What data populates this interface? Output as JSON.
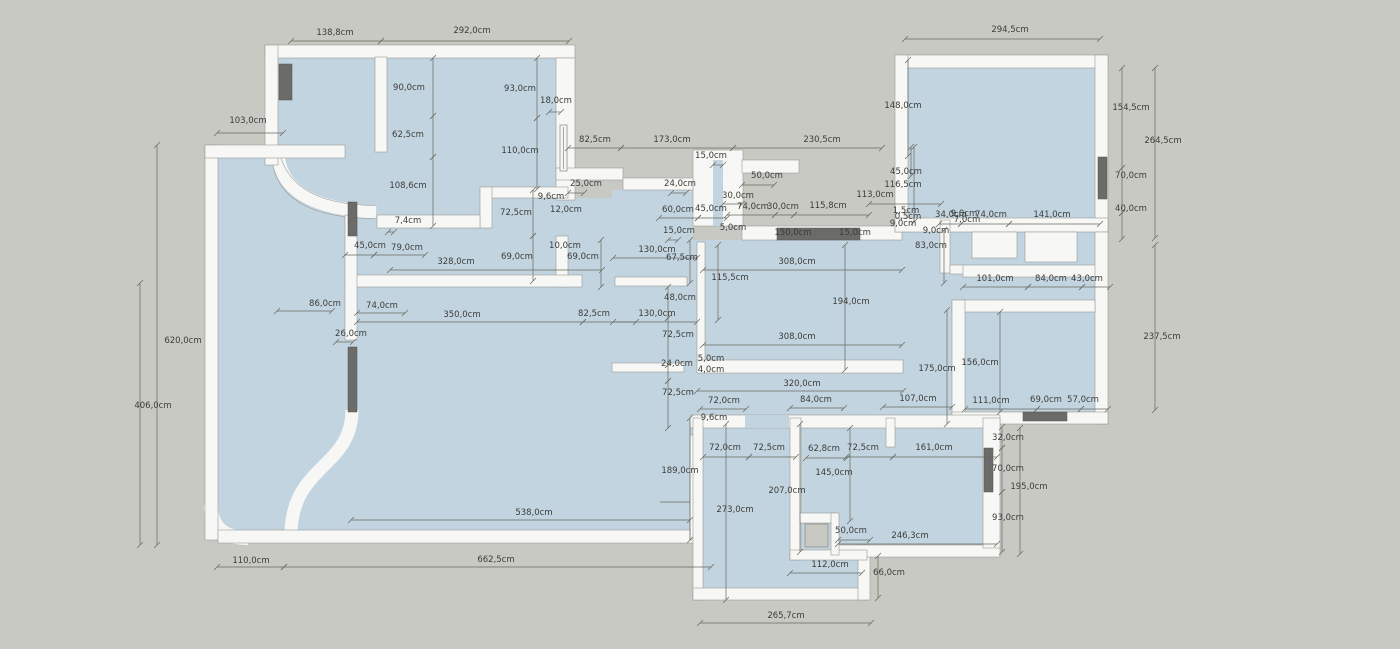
{
  "title": "apartment-floor-plan",
  "unit": "cm",
  "colors": {
    "background": "#c9c9c4",
    "floor": "#c3d4e1",
    "wall": "#f7f7f5",
    "wall_edge": "#9a9a96",
    "opening_dark": "#6b6b69",
    "dimension_line": "#68685f",
    "dimension_text": "#3c3c38"
  },
  "dimensions": [
    {
      "text": "138,8cm",
      "x": 335,
      "y": 35,
      "line": [
        291,
        41,
        381,
        41
      ]
    },
    {
      "text": "292,0cm",
      "x": 472,
      "y": 33,
      "line": [
        381,
        41,
        569,
        41
      ]
    },
    {
      "text": "294,5cm",
      "x": 1010,
      "y": 32,
      "line": [
        905,
        39,
        1100,
        39
      ]
    },
    {
      "text": "103,0cm",
      "x": 248,
      "y": 123,
      "line": [
        217,
        133,
        283,
        133
      ]
    },
    {
      "text": "90,0cm",
      "x": 409,
      "y": 90,
      "line": [
        433,
        58,
        433,
        116
      ]
    },
    {
      "text": "62,5cm",
      "x": 408,
      "y": 137,
      "line": [
        433,
        116,
        433,
        157
      ]
    },
    {
      "text": "108,6cm",
      "x": 408,
      "y": 188,
      "line": [
        433,
        157,
        433,
        226
      ]
    },
    {
      "text": "7,4cm",
      "x": 408,
      "y": 223,
      "line": [
        388,
        232,
        394,
        232
      ]
    },
    {
      "text": "93,0cm",
      "x": 520,
      "y": 91,
      "line": [
        537,
        58,
        537,
        118
      ]
    },
    {
      "text": "18,0cm",
      "x": 556,
      "y": 103,
      "line": [
        549,
        112,
        561,
        112
      ]
    },
    {
      "text": "110,0cm",
      "x": 520,
      "y": 153,
      "line": [
        537,
        118,
        537,
        189
      ]
    },
    {
      "text": "25,0cm",
      "x": 586,
      "y": 186,
      "line": [
        568,
        193,
        584,
        193
      ]
    },
    {
      "text": "9,6cm",
      "x": 551,
      "y": 199
    },
    {
      "text": "12,0cm",
      "x": 566,
      "y": 212
    },
    {
      "text": "72,5cm",
      "x": 516,
      "y": 215,
      "line": [
        533,
        190,
        533,
        236
      ]
    },
    {
      "text": "45,0cm",
      "x": 370,
      "y": 248,
      "line": [
        345,
        255,
        374,
        255
      ]
    },
    {
      "text": "79,0cm",
      "x": 407,
      "y": 250,
      "line": [
        374,
        255,
        425,
        255
      ]
    },
    {
      "text": "328,0cm",
      "x": 456,
      "y": 264,
      "line": [
        390,
        270,
        602,
        270
      ]
    },
    {
      "text": "69,0cm",
      "x": 517,
      "y": 259,
      "line": [
        533,
        236,
        533,
        281
      ]
    },
    {
      "text": "10,0cm",
      "x": 565,
      "y": 248
    },
    {
      "text": "69,0cm",
      "x": 583,
      "y": 259,
      "line": [
        601,
        240,
        601,
        287
      ]
    },
    {
      "text": "86,0cm",
      "x": 325,
      "y": 306,
      "line": [
        277,
        311,
        332,
        311
      ]
    },
    {
      "text": "74,0cm",
      "x": 382,
      "y": 308,
      "line": [
        357,
        313,
        405,
        313
      ]
    },
    {
      "text": "350,0cm",
      "x": 462,
      "y": 317,
      "line": [
        357,
        322,
        583,
        322
      ]
    },
    {
      "text": "82,5cm",
      "x": 594,
      "y": 316,
      "line": [
        583,
        322,
        636,
        322
      ]
    },
    {
      "text": "26,0cm",
      "x": 351,
      "y": 336,
      "line": [
        336,
        342,
        353,
        342
      ]
    },
    {
      "text": "620,0cm",
      "x": 183,
      "y": 343,
      "line": [
        157,
        145,
        157,
        545
      ]
    },
    {
      "text": "406,0cm",
      "x": 153,
      "y": 408,
      "line": [
        140,
        283,
        140,
        545
      ]
    },
    {
      "text": "110,0cm",
      "x": 251,
      "y": 563,
      "line": [
        217,
        567,
        284,
        567
      ]
    },
    {
      "text": "662,5cm",
      "x": 496,
      "y": 562,
      "line": [
        284,
        567,
        711,
        567
      ]
    },
    {
      "text": "538,0cm",
      "x": 534,
      "y": 515,
      "line": [
        351,
        520,
        690,
        520
      ]
    },
    {
      "text": "82,5cm",
      "x": 595,
      "y": 142,
      "line": [
        568,
        148,
        621,
        148
      ]
    },
    {
      "text": "173,0cm",
      "x": 672,
      "y": 142,
      "line": [
        621,
        148,
        733,
        148
      ]
    },
    {
      "text": "230,5cm",
      "x": 822,
      "y": 142,
      "line": [
        733,
        148,
        882,
        148
      ]
    },
    {
      "text": "15,0cm",
      "x": 711,
      "y": 158,
      "line": [
        713,
        165,
        723,
        165
      ]
    },
    {
      "text": "24,0cm",
      "x": 680,
      "y": 186,
      "line": [
        671,
        193,
        686,
        193
      ]
    },
    {
      "text": "50,0cm",
      "x": 767,
      "y": 178,
      "line": [
        742,
        185,
        774,
        185
      ]
    },
    {
      "text": "30,0cm",
      "x": 738,
      "y": 198,
      "line": [
        723,
        204,
        742,
        204
      ]
    },
    {
      "text": "60,0cm",
      "x": 678,
      "y": 212,
      "line": [
        659,
        218,
        698,
        218
      ]
    },
    {
      "text": "45,0cm",
      "x": 711,
      "y": 211,
      "line": [
        698,
        218,
        727,
        218
      ]
    },
    {
      "text": "74,0cm",
      "x": 753,
      "y": 209,
      "line": [
        727,
        215,
        775,
        215
      ]
    },
    {
      "text": "30,0cm",
      "x": 783,
      "y": 209,
      "line": [
        775,
        215,
        794,
        215
      ]
    },
    {
      "text": "115,8cm",
      "x": 828,
      "y": 208,
      "line": [
        794,
        215,
        869,
        215
      ]
    },
    {
      "text": "113,0cm",
      "x": 875,
      "y": 197,
      "line": [
        869,
        204,
        941,
        204
      ]
    },
    {
      "text": "15,0cm",
      "x": 679,
      "y": 233,
      "line": [
        668,
        240,
        678,
        240
      ]
    },
    {
      "text": "5,0cm",
      "x": 733,
      "y": 230
    },
    {
      "text": "150,0cm",
      "x": 793,
      "y": 235
    },
    {
      "text": "15,0cm",
      "x": 855,
      "y": 235
    },
    {
      "text": "148,0cm",
      "x": 903,
      "y": 108,
      "line": [
        908,
        60,
        908,
        156
      ]
    },
    {
      "text": "45,0cm",
      "x": 906,
      "y": 174,
      "line": [
        911,
        147,
        911,
        176
      ]
    },
    {
      "text": "116,5cm",
      "x": 903,
      "y": 187,
      "line": [
        914,
        147,
        914,
        222
      ]
    },
    {
      "text": "1,5cm",
      "x": 906,
      "y": 213
    },
    {
      "text": "0,5cm",
      "x": 908,
      "y": 219
    },
    {
      "text": "9,0cm",
      "x": 903,
      "y": 226
    },
    {
      "text": "9,0cm",
      "x": 964,
      "y": 216
    },
    {
      "text": "7,0cm",
      "x": 967,
      "y": 222
    },
    {
      "text": "9,0cm",
      "x": 936,
      "y": 233
    },
    {
      "text": "83,0cm",
      "x": 931,
      "y": 248,
      "line": [
        944,
        230,
        944,
        283
      ]
    },
    {
      "text": "34,0cm",
      "x": 951,
      "y": 217,
      "line": [
        939,
        224,
        961,
        224
      ]
    },
    {
      "text": "74,0cm",
      "x": 991,
      "y": 217,
      "line": [
        961,
        224,
        1009,
        224
      ]
    },
    {
      "text": "141,0cm",
      "x": 1052,
      "y": 217,
      "line": [
        1009,
        224,
        1100,
        224
      ]
    },
    {
      "text": "154,5cm",
      "x": 1131,
      "y": 110,
      "line": [
        1122,
        68,
        1122,
        168
      ]
    },
    {
      "text": "264,5cm",
      "x": 1163,
      "y": 143,
      "line": [
        1155,
        68,
        1155,
        238
      ]
    },
    {
      "text": "70,0cm",
      "x": 1131,
      "y": 178,
      "line": [
        1122,
        168,
        1122,
        213
      ]
    },
    {
      "text": "40,0cm",
      "x": 1131,
      "y": 211,
      "line": [
        1122,
        213,
        1122,
        239
      ]
    },
    {
      "text": "101,0cm",
      "x": 995,
      "y": 281,
      "line": [
        963,
        287,
        1028,
        287
      ]
    },
    {
      "text": "84,0cm",
      "x": 1051,
      "y": 281,
      "line": [
        1028,
        287,
        1082,
        287
      ]
    },
    {
      "text": "43,0cm",
      "x": 1087,
      "y": 281,
      "line": [
        1082,
        287,
        1110,
        287
      ]
    },
    {
      "text": "237,5cm",
      "x": 1162,
      "y": 339,
      "line": [
        1155,
        245,
        1155,
        410
      ]
    },
    {
      "text": "130,0cm",
      "x": 657,
      "y": 252,
      "line": [
        613,
        258,
        697,
        258
      ]
    },
    {
      "text": "67,5cm",
      "x": 682,
      "y": 260,
      "line": [
        690,
        240,
        690,
        283
      ]
    },
    {
      "text": "115,5cm",
      "x": 730,
      "y": 280,
      "line": [
        718,
        245,
        718,
        320
      ]
    },
    {
      "text": "308,0cm",
      "x": 797,
      "y": 264,
      "line": [
        703,
        270,
        902,
        270
      ]
    },
    {
      "text": "194,0cm",
      "x": 851,
      "y": 304,
      "line": [
        845,
        245,
        845,
        370
      ]
    },
    {
      "text": "48,0cm",
      "x": 680,
      "y": 300,
      "line": [
        668,
        287,
        668,
        318
      ]
    },
    {
      "text": "130,0cm",
      "x": 657,
      "y": 316,
      "line": [
        613,
        322,
        697,
        322
      ]
    },
    {
      "text": "72,5cm",
      "x": 678,
      "y": 337,
      "line": [
        668,
        318,
        668,
        365
      ]
    },
    {
      "text": "308,0cm",
      "x": 797,
      "y": 339,
      "line": [
        703,
        345,
        902,
        345
      ]
    },
    {
      "text": "24,0cm",
      "x": 677,
      "y": 366,
      "line": [
        668,
        365,
        668,
        381
      ]
    },
    {
      "text": "5,0cm",
      "x": 711,
      "y": 361
    },
    {
      "text": "4,0cm",
      "x": 711,
      "y": 372
    },
    {
      "text": "320,0cm",
      "x": 802,
      "y": 386,
      "line": [
        697,
        391,
        903,
        391
      ]
    },
    {
      "text": "72,5cm",
      "x": 678,
      "y": 395,
      "line": [
        668,
        381,
        668,
        428
      ]
    },
    {
      "text": "175,0cm",
      "x": 937,
      "y": 371,
      "line": [
        947,
        310,
        947,
        424
      ]
    },
    {
      "text": "156,0cm",
      "x": 980,
      "y": 365,
      "line": [
        1000,
        312,
        1000,
        412
      ]
    },
    {
      "text": "107,0cm",
      "x": 918,
      "y": 401,
      "line": [
        883,
        407,
        952,
        407
      ]
    },
    {
      "text": "111,0cm",
      "x": 991,
      "y": 403,
      "line": [
        965,
        409,
        1037,
        409
      ]
    },
    {
      "text": "69,0cm",
      "x": 1046,
      "y": 402,
      "line": [
        1037,
        409,
        1081,
        409
      ]
    },
    {
      "text": "57,0cm",
      "x": 1083,
      "y": 402,
      "line": [
        1081,
        409,
        1108,
        409
      ]
    },
    {
      "text": "72,0cm",
      "x": 724,
      "y": 403,
      "line": [
        700,
        409,
        746,
        409
      ]
    },
    {
      "text": "84,0cm",
      "x": 816,
      "y": 402,
      "line": [
        790,
        408,
        844,
        408
      ]
    },
    {
      "text": "9,6cm",
      "x": 714,
      "y": 420
    },
    {
      "text": "72,0cm",
      "x": 725,
      "y": 450,
      "line": [
        703,
        457,
        749,
        457
      ]
    },
    {
      "text": "72,5cm",
      "x": 769,
      "y": 450,
      "line": [
        749,
        457,
        796,
        457
      ]
    },
    {
      "text": "62,8cm",
      "x": 824,
      "y": 451,
      "line": [
        806,
        458,
        847,
        458
      ]
    },
    {
      "text": "72,5cm",
      "x": 863,
      "y": 450,
      "line": [
        846,
        457,
        893,
        457
      ]
    },
    {
      "text": "161,0cm",
      "x": 934,
      "y": 450,
      "line": [
        893,
        457,
        997,
        457
      ]
    },
    {
      "text": "145,0cm",
      "x": 834,
      "y": 475,
      "line": [
        850,
        428,
        850,
        521
      ]
    },
    {
      "text": "207,0cm",
      "x": 787,
      "y": 493,
      "line": [
        800,
        424,
        800,
        552
      ]
    },
    {
      "text": "273,0cm",
      "x": 735,
      "y": 512,
      "line": [
        726,
        424,
        726,
        600
      ]
    },
    {
      "text": "189,0cm",
      "x": 680,
      "y": 473,
      "line": [
        690,
        418,
        690,
        540
      ]
    },
    {
      "text": "50,0cm",
      "x": 851,
      "y": 533,
      "line": [
        838,
        540,
        870,
        540
      ]
    },
    {
      "text": "246,3cm",
      "x": 910,
      "y": 538,
      "line": [
        838,
        544,
        997,
        544
      ]
    },
    {
      "text": "112,0cm",
      "x": 830,
      "y": 567,
      "line": [
        790,
        573,
        862,
        573
      ]
    },
    {
      "text": "66,0cm",
      "x": 889,
      "y": 575,
      "line": [
        878,
        556,
        878,
        598
      ]
    },
    {
      "text": "265,7cm",
      "x": 786,
      "y": 618,
      "line": [
        700,
        623,
        871,
        623
      ]
    },
    {
      "text": "93,0cm",
      "x": 1008,
      "y": 520,
      "line": [
        1002,
        492,
        1002,
        552
      ]
    },
    {
      "text": "195,0cm",
      "x": 1029,
      "y": 489,
      "line": [
        1020,
        428,
        1020,
        554
      ]
    },
    {
      "text": "70,0cm",
      "x": 1008,
      "y": 471,
      "line": [
        1002,
        448,
        1002,
        492
      ]
    },
    {
      "text": "32,0cm",
      "x": 1008,
      "y": 440,
      "line": [
        1002,
        427,
        1002,
        448
      ]
    }
  ]
}
